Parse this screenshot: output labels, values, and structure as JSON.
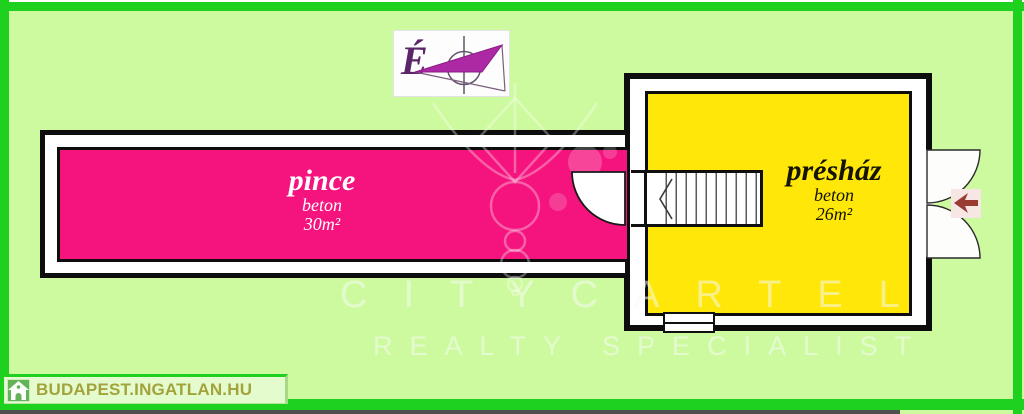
{
  "page": {
    "background_color": "#CEFA9F",
    "frame_color": "#1FD11F"
  },
  "compass": {
    "north_label": "É",
    "needle_color": "#AD28A5"
  },
  "rooms": {
    "pince": {
      "name": "pince",
      "material": "beton",
      "area": "30m²",
      "fill_color": "#F5137E",
      "text_color": "#FFFFFF"
    },
    "preshaz": {
      "name": "présház",
      "material": "beton",
      "area": "26m²",
      "fill_color": "#FFE70A",
      "text_color": "#141400"
    }
  },
  "entrance_arrow": {
    "color": "#9B3A30",
    "direction": "left"
  },
  "watermark": {
    "brand": "CITYCARTEL",
    "tagline": "REALTY SPECIALIST"
  },
  "footer": {
    "site_name": "BUDAPEST.INGATLAN.HU"
  }
}
